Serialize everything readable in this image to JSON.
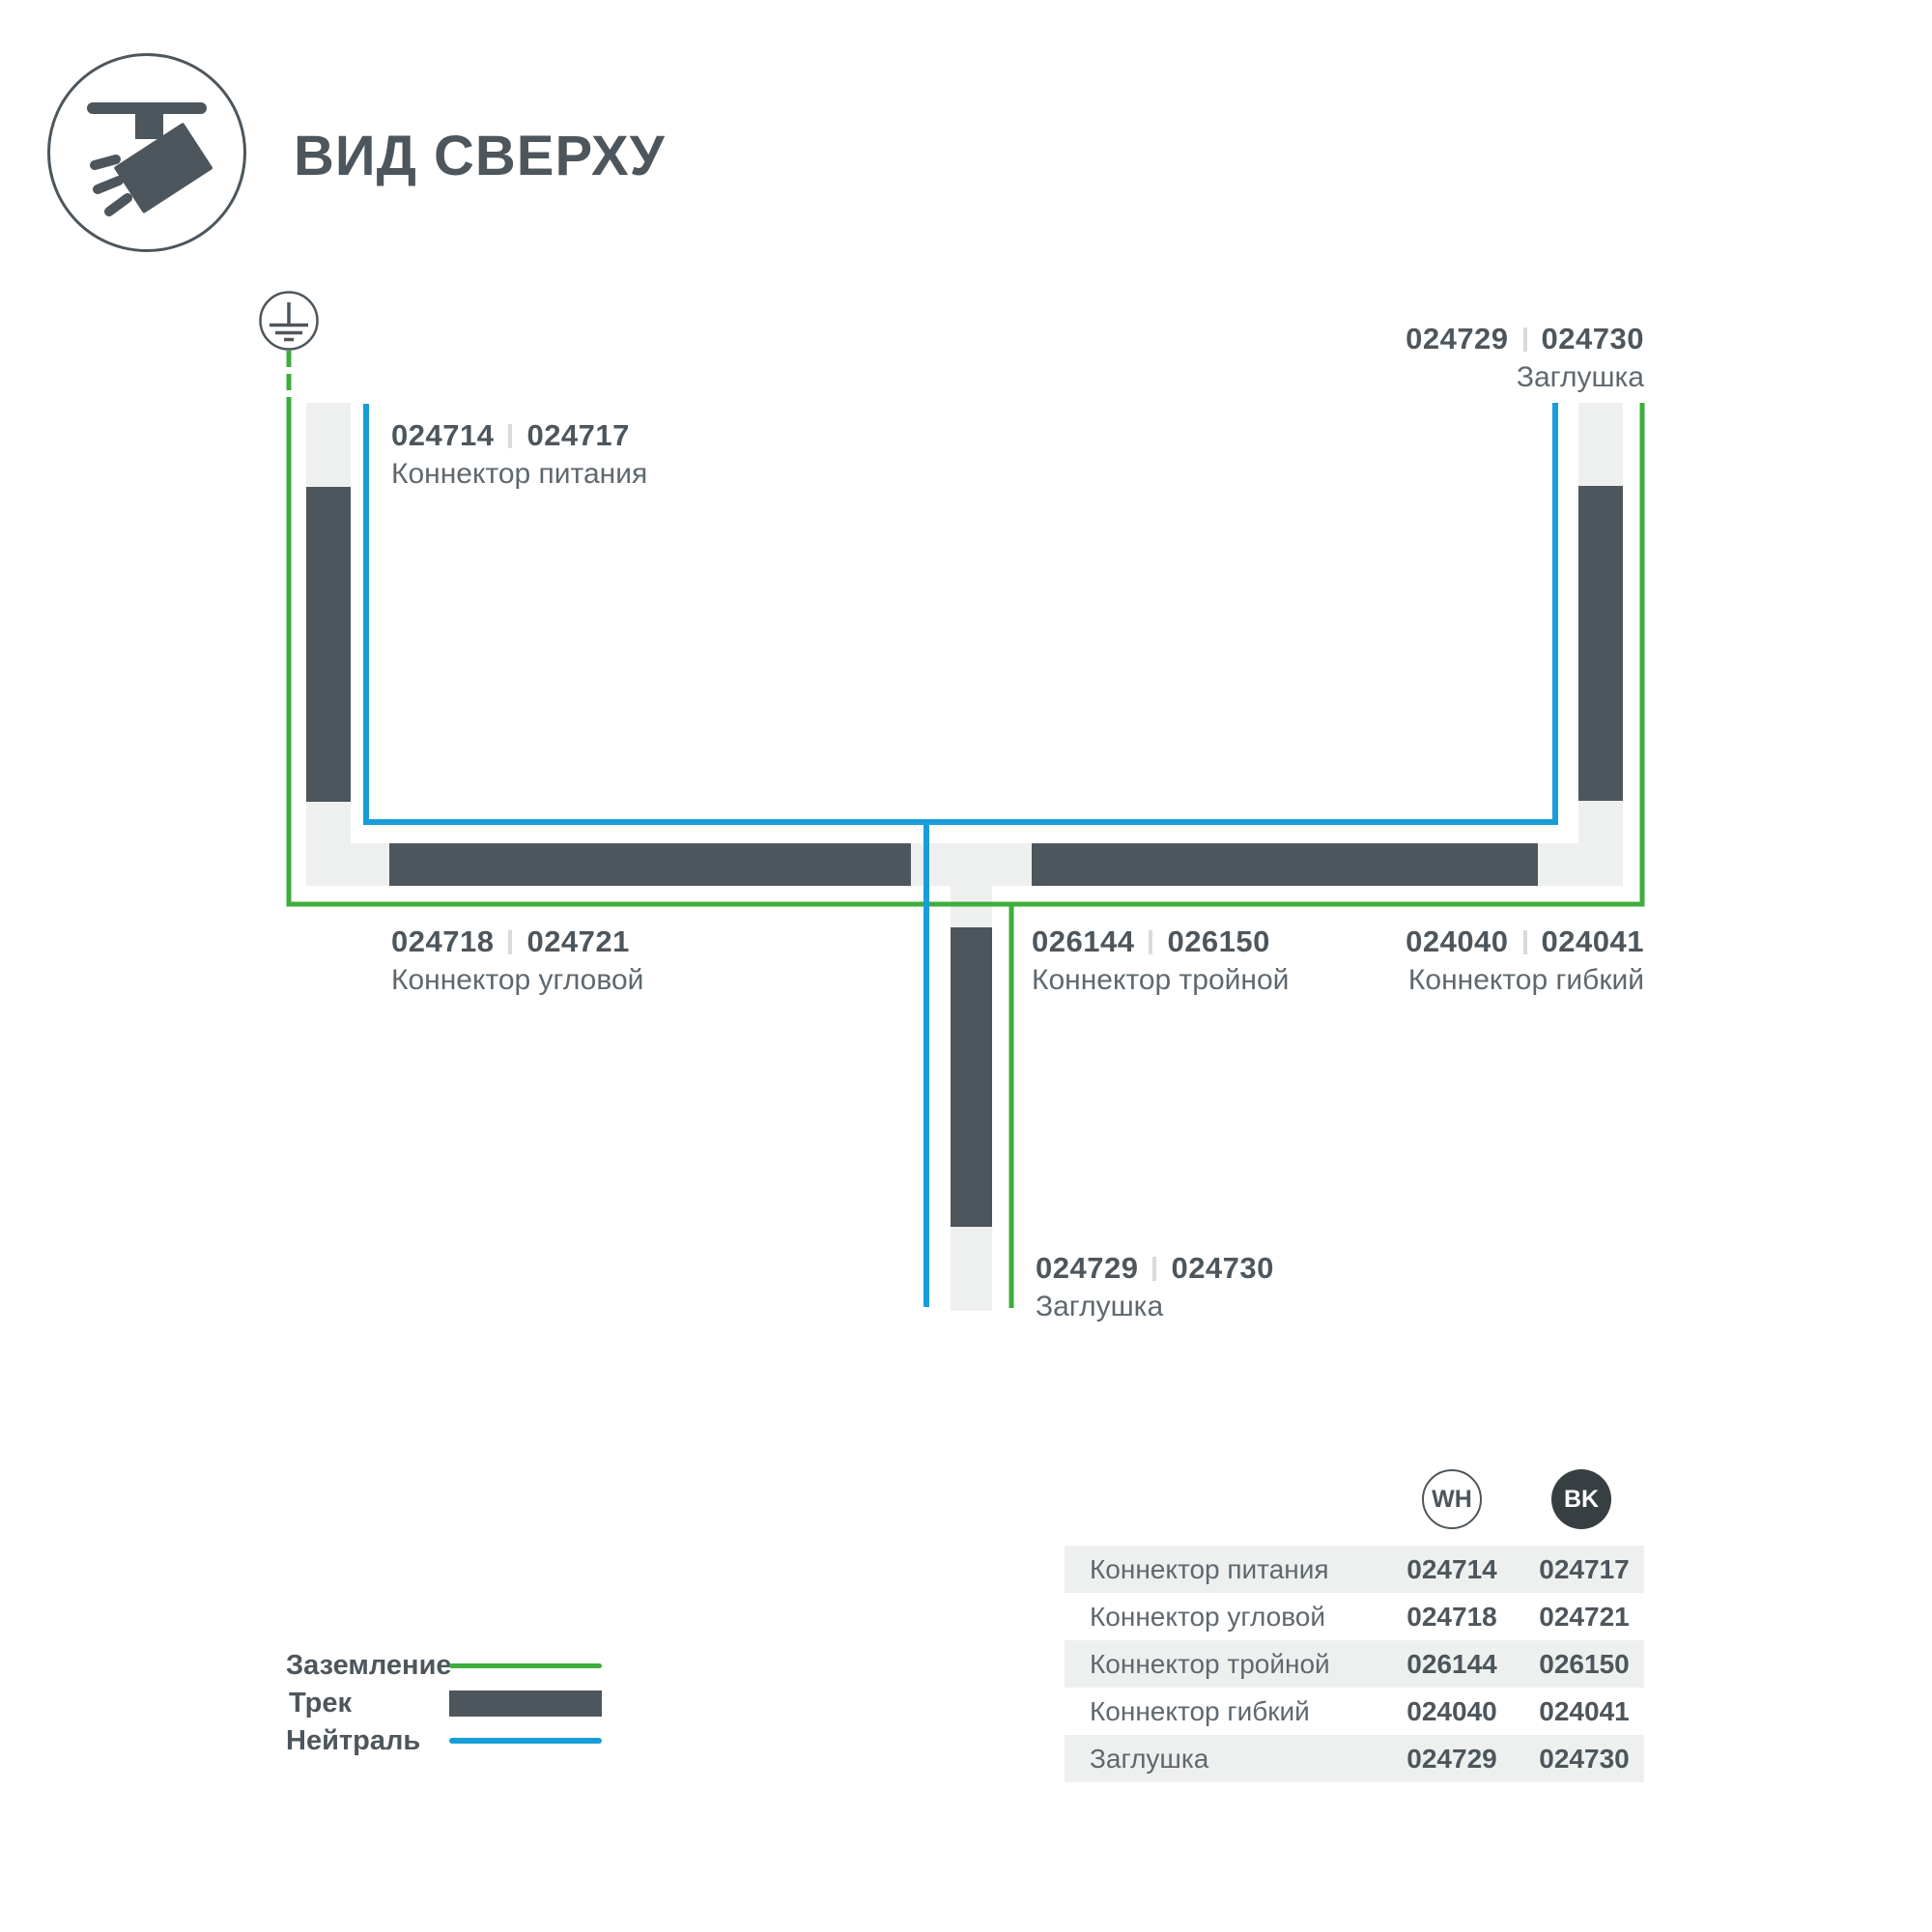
{
  "header": {
    "title": "ВИД СВЕРХУ"
  },
  "diagram": {
    "labels": {
      "power": {
        "code_wh": "024714",
        "code_bk": "024717",
        "name": "Коннектор питания"
      },
      "cap_top": {
        "code_wh": "024729",
        "code_bk": "024730",
        "name": "Заглушка"
      },
      "corner": {
        "code_wh": "024718",
        "code_bk": "024721",
        "name": "Коннектор угловой"
      },
      "triple": {
        "code_wh": "026144",
        "code_bk": "026150",
        "name": "Коннектор тройной"
      },
      "flex": {
        "code_wh": "024040",
        "code_bk": "024041",
        "name": "Коннектор гибкий"
      },
      "cap_bottom": {
        "code_wh": "024729",
        "code_bk": "024730",
        "name": "Заглушка"
      }
    }
  },
  "legend": {
    "ground": "Заземление",
    "track": "Трек",
    "neutral": "Нейтраль"
  },
  "table": {
    "col_wh": "WH",
    "col_bk": "BK",
    "rows": [
      {
        "name": "Коннектор питания",
        "wh": "024714",
        "bk": "024717"
      },
      {
        "name": "Коннектор угловой",
        "wh": "024718",
        "bk": "024721"
      },
      {
        "name": "Коннектор тройной",
        "wh": "026144",
        "bk": "026150"
      },
      {
        "name": "Коннектор гибкий",
        "wh": "024040",
        "bk": "024041"
      },
      {
        "name": "Заглушка",
        "wh": "024729",
        "bk": "024730"
      }
    ]
  },
  "colors": {
    "ground_green": "#3dad3b",
    "neutral_blue": "#189dd9",
    "track_dark": "#4d565c",
    "housing_light": "#eef0ef"
  }
}
